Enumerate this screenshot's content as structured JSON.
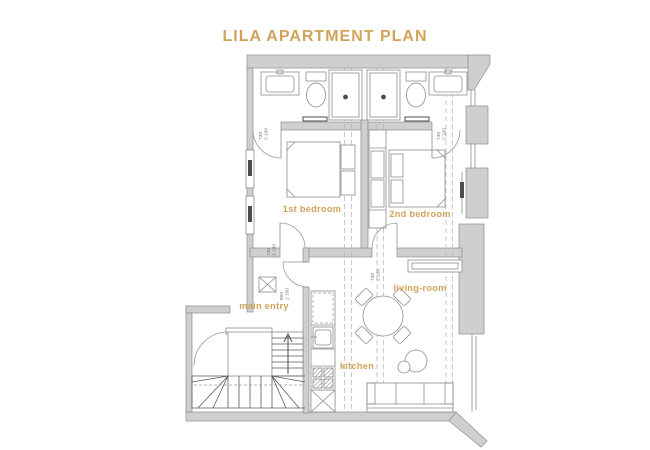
{
  "title": "LILA APARTMENT PLAN",
  "colors": {
    "accent": "#D0A359",
    "wall_fill": "#CFCFCF",
    "wall_stroke": "#8E8E8E",
    "drawing_line": "#8C8C8C",
    "dark_line": "#4d4d4d"
  },
  "rooms": {
    "bedroom1": "1st bedroom",
    "bedroom2": "2nd bedroom",
    "main_entry": "main entry",
    "living_room": "living-room",
    "kitchen": "kitchen"
  },
  "door_dims": {
    "bath1": {
      "w": "730",
      "h": "2 100"
    },
    "bath2": {
      "w": "730",
      "h": "2 100"
    },
    "bedroom1": {
      "w": "730",
      "h": "2 100"
    },
    "bedroom2": {
      "w": "730",
      "h": "2 100"
    },
    "hall_living": {
      "w": "800",
      "h": "2 100"
    }
  }
}
